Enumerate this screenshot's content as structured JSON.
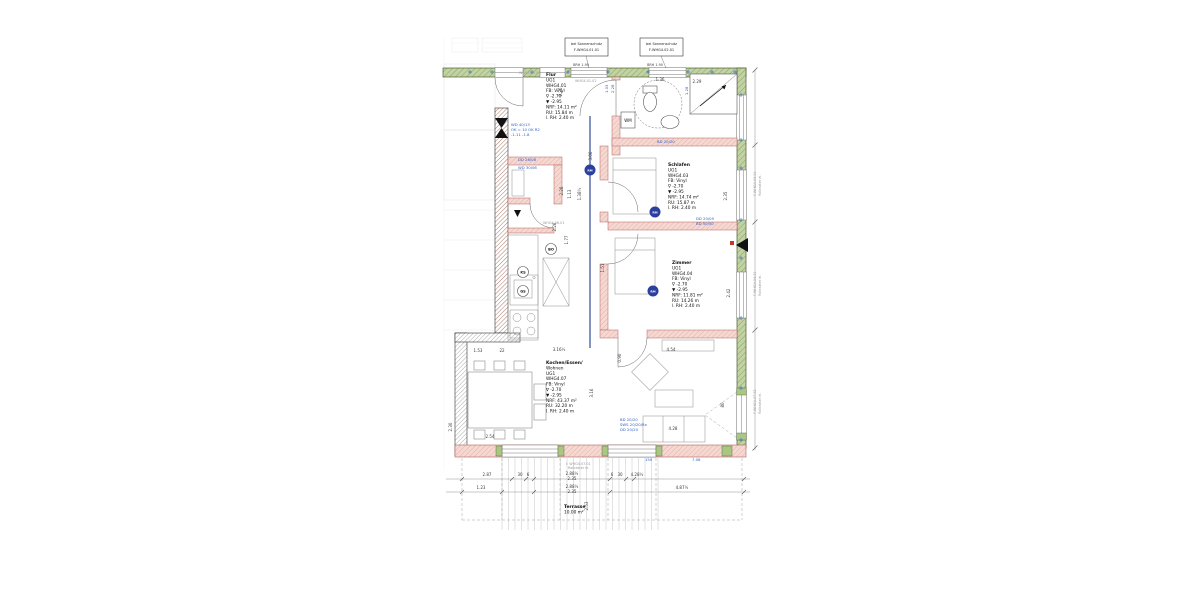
{
  "colors": {
    "exterior_wall_green": "#bccd9c",
    "exterior_wall_edge": "#4a5f33",
    "new_wall_pink": "#f4d2cc",
    "new_wall_edge": "#b4635c",
    "existing_wall_hatch": "#925a48",
    "cad_blue": "#2f5fc1",
    "section_blue": "#1f3d8c",
    "dimension_text": "#3a3a3a"
  },
  "room_blocks": [
    {
      "id": "flur",
      "x": 546,
      "y": 76,
      "lines": [
        "Flur",
        "UG1",
        "WHG4.01",
        "FB: Vinyl",
        "∇ -2.70",
        "▼ -2.95",
        "NRF: 14.11 m²",
        "RU: 15.84 m",
        "l. RH: 2.40 m"
      ]
    },
    {
      "id": "schlafen",
      "x": 668,
      "y": 166,
      "lines": [
        "Schlafen",
        "UG1",
        "WHG4.03",
        "FB: Vinyl",
        "∇ -2.70",
        "▼ -2.95",
        "NRF: 14.74 m²",
        "RU: 15.87 m",
        "l. RH: 2.40 m"
      ]
    },
    {
      "id": "zimmer",
      "x": 672,
      "y": 264,
      "lines": [
        "Zimmer",
        "UG1",
        "WHG4.04",
        "FB: Vinyl",
        "∇ -2.70",
        "▼ -2.95",
        "NRF: 11.81 m²",
        "RU: 14.26 m",
        "l. RH: 2.40 m"
      ]
    },
    {
      "id": "kochen-essen-wohnen",
      "x": 546,
      "y": 364,
      "lines": [
        "Kochen/Essen/",
        "Wohnen",
        "UG1",
        "WHG4.07",
        "FB: Vinyl",
        "∇ -2.70",
        "▼ -2.95",
        "NRF: 43.37 m²",
        "RU: 32.20 m",
        "l. RH: 2.40 m"
      ]
    },
    {
      "id": "terrasse",
      "x": 564,
      "y": 508,
      "lines": [
        "Terrasse",
        "10.00 m²"
      ]
    }
  ],
  "annotations": {
    "sz1": [
      "bei Sonnenschutz",
      "F-WHG4.01.01"
    ],
    "sz2": [
      "bei Sonnenschutz",
      "F-WHG4.02.01"
    ],
    "brh": "BRH 1.90",
    "wm": "WM",
    "rm": "RM"
  },
  "kitchen": {
    "appl1": "BO",
    "appl2": "KS",
    "appl3": "GS"
  },
  "dims": [
    {
      "t": "2.87",
      "x": 487,
      "y": 476
    },
    {
      "t": "30",
      "x": 520,
      "y": 476
    },
    {
      "t": "6",
      "x": 528,
      "y": 476
    },
    {
      "t": "2.88½",
      "x": 572,
      "y": 475
    },
    {
      "t": "2.35",
      "x": 572,
      "y": 480
    },
    {
      "t": "6",
      "x": 612,
      "y": 476
    },
    {
      "t": "30",
      "x": 620,
      "y": 476
    },
    {
      "t": "4.28½",
      "x": 637,
      "y": 476
    },
    {
      "t": "1.23",
      "x": 481,
      "y": 489
    },
    {
      "t": "2.88½",
      "x": 572,
      "y": 488
    },
    {
      "t": "2.35",
      "x": 572,
      "y": 493
    },
    {
      "t": "4.87½",
      "x": 682,
      "y": 489
    },
    {
      "t": "2.53",
      "x": 588,
      "y": 506,
      "r": -90
    },
    {
      "t": "1.53",
      "x": 478,
      "y": 352
    },
    {
      "t": "22",
      "x": 502,
      "y": 352
    },
    {
      "t": "3.16½",
      "x": 559,
      "y": 351
    },
    {
      "t": "2.54",
      "x": 490,
      "y": 438
    },
    {
      "t": "4.54",
      "x": 671,
      "y": 351
    },
    {
      "t": "0.90",
      "x": 621,
      "y": 358,
      "r": -90
    },
    {
      "t": "4.28",
      "x": 673,
      "y": 430
    },
    {
      "t": "3.16",
      "x": 593,
      "y": 393,
      "r": -90
    },
    {
      "t": "3.06",
      "x": 592,
      "y": 156,
      "r": -90
    },
    {
      "t": "2.26",
      "x": 562,
      "y": 92,
      "r": -90
    },
    {
      "t": "2.26",
      "x": 563,
      "y": 191,
      "r": -90
    },
    {
      "t": "1.13",
      "x": 571,
      "y": 194,
      "r": -90
    },
    {
      "t": "1.38½",
      "x": 581,
      "y": 194,
      "r": -90
    },
    {
      "t": "2.26",
      "x": 556,
      "y": 227,
      "r": -90
    },
    {
      "t": "1.77",
      "x": 568,
      "y": 240,
      "r": -90
    },
    {
      "t": "1.51",
      "x": 604,
      "y": 268,
      "r": -90
    },
    {
      "t": "2.35",
      "x": 727,
      "y": 196,
      "r": -90
    },
    {
      "t": "2.42",
      "x": 730,
      "y": 293,
      "r": -90
    },
    {
      "t": "80",
      "x": 724,
      "y": 405,
      "r": -90
    },
    {
      "t": "2.30",
      "x": 452,
      "y": 427,
      "r": -90
    },
    {
      "t": "1.36",
      "x": 660,
      "y": 81
    },
    {
      "t": "2.29",
      "x": 697,
      "y": 83
    }
  ],
  "blue_notes": [
    {
      "t": "WD 40/13",
      "x": 511,
      "y": 126
    },
    {
      "t": "OK = 10 OK R2",
      "x": 511,
      "y": 131
    },
    {
      "t": "-1.11  -1.8",
      "x": 511,
      "y": 136
    },
    {
      "t": "DD 26/08",
      "x": 518,
      "y": 161
    },
    {
      "t": "WD 30/06",
      "x": 518,
      "y": 169
    },
    {
      "t": "BD 20/20",
      "x": 657,
      "y": 143
    },
    {
      "t": "DD 20/05",
      "x": 696,
      "y": 220
    },
    {
      "t": "BD 50/50",
      "x": 696,
      "y": 225
    },
    {
      "t": "BD 20/20",
      "x": 620,
      "y": 421
    },
    {
      "t": "SWS 20/20/Rx",
      "x": 620,
      "y": 426
    },
    {
      "t": "DD 20/20",
      "x": 620,
      "y": 431
    },
    {
      "t": "150",
      "x": 645,
      "y": 461
    },
    {
      "t": "7.06",
      "x": 692,
      "y": 461
    },
    {
      "t": "2.28",
      "x": 614,
      "y": 93,
      "r": -90
    },
    {
      "t": "1.03",
      "x": 608,
      "y": 93,
      "r": -90
    },
    {
      "t": "1.28",
      "x": 688,
      "y": 95,
      "r": -90
    }
  ],
  "grey_notes": [
    {
      "t": "WHG4.01.01",
      "x": 519,
      "y": 74
    },
    {
      "t": "WHG4.01.02",
      "x": 575,
      "y": 82
    },
    {
      "t": "WHG4.06.01",
      "x": 543,
      "y": 224
    },
    {
      "t": "I: WHG4.07.01",
      "x": 566,
      "y": 465
    },
    {
      "t": "Rollraster el.",
      "x": 568,
      "y": 469
    },
    {
      "t": "F-WHG4.03.01",
      "x": 756,
      "y": 196,
      "r": -90
    },
    {
      "t": "Rollraster el.",
      "x": 761,
      "y": 196,
      "r": -90
    },
    {
      "t": "F-WHG4.04.01",
      "x": 756,
      "y": 296,
      "r": -90
    },
    {
      "t": "Rollraster el.",
      "x": 761,
      "y": 296,
      "r": -90
    },
    {
      "t": "F-WHG4.07.02",
      "x": 756,
      "y": 414,
      "r": -90
    },
    {
      "t": "Rollraster el.",
      "x": 761,
      "y": 414,
      "r": -90
    }
  ]
}
